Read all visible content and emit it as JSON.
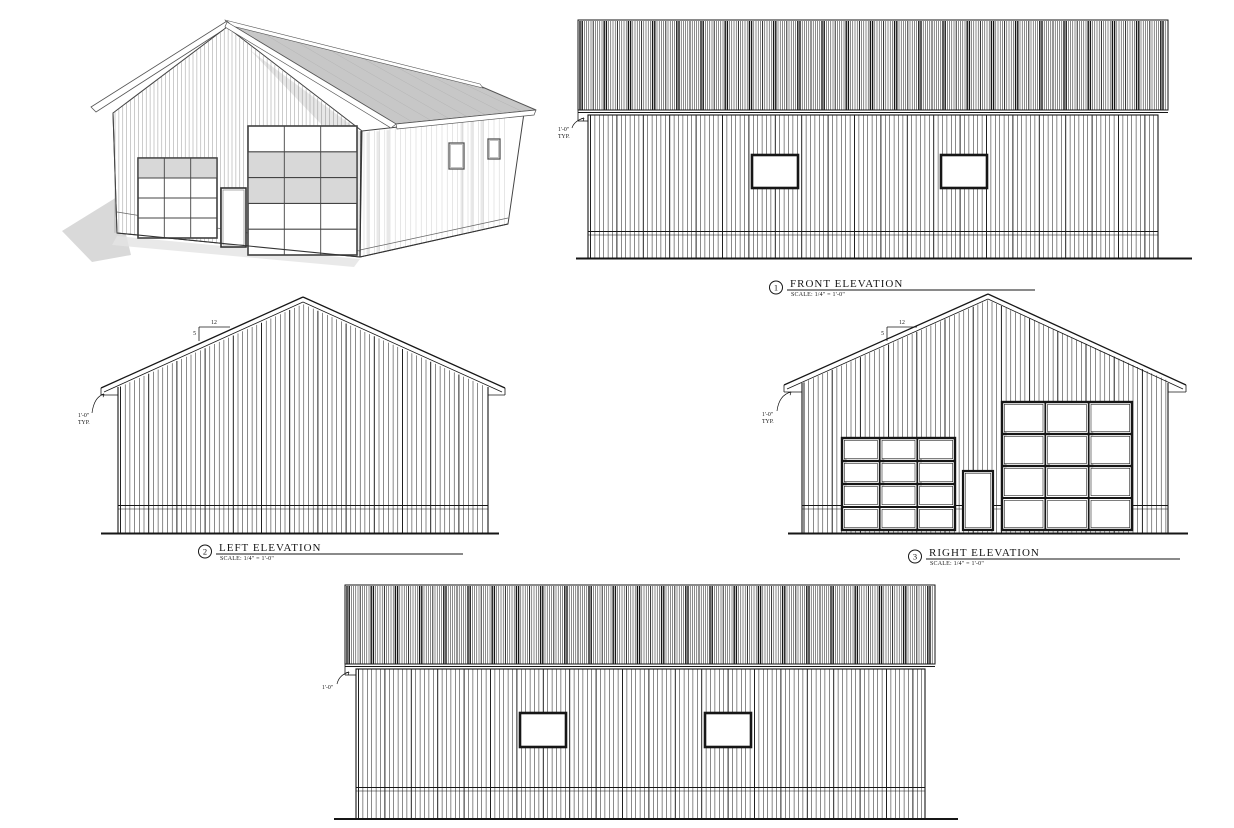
{
  "sheet": {
    "kind": "building elevation drawings"
  },
  "colors": {
    "paper": "#ffffff",
    "ink": "#161616",
    "sketch": "#4a4a4a",
    "roof_gray": "#c7c7c7",
    "shadow_gray": "#d9d9d9",
    "soft_shadow": "#e4e4e4",
    "panel_gray": "#d8d8d8",
    "wall_shade": "#cfcfcf"
  },
  "titles": {
    "front": {
      "number": "1",
      "title": "FRONT ELEVATION",
      "scale": "SCALE: 1/4\" = 1'-0\""
    },
    "left": {
      "number": "2",
      "title": "LEFT ELEVATION",
      "scale": "SCALE: 1/4\" = 1'-0\""
    },
    "right": {
      "number": "3",
      "title": "RIGHT ELEVATION",
      "scale": "SCALE: 1/4\" = 1'-0\""
    }
  },
  "annotations": {
    "eave_overhang": "1'-0\"",
    "typ": "TYP.",
    "pitch_run": "12",
    "pitch_rise": "5"
  }
}
